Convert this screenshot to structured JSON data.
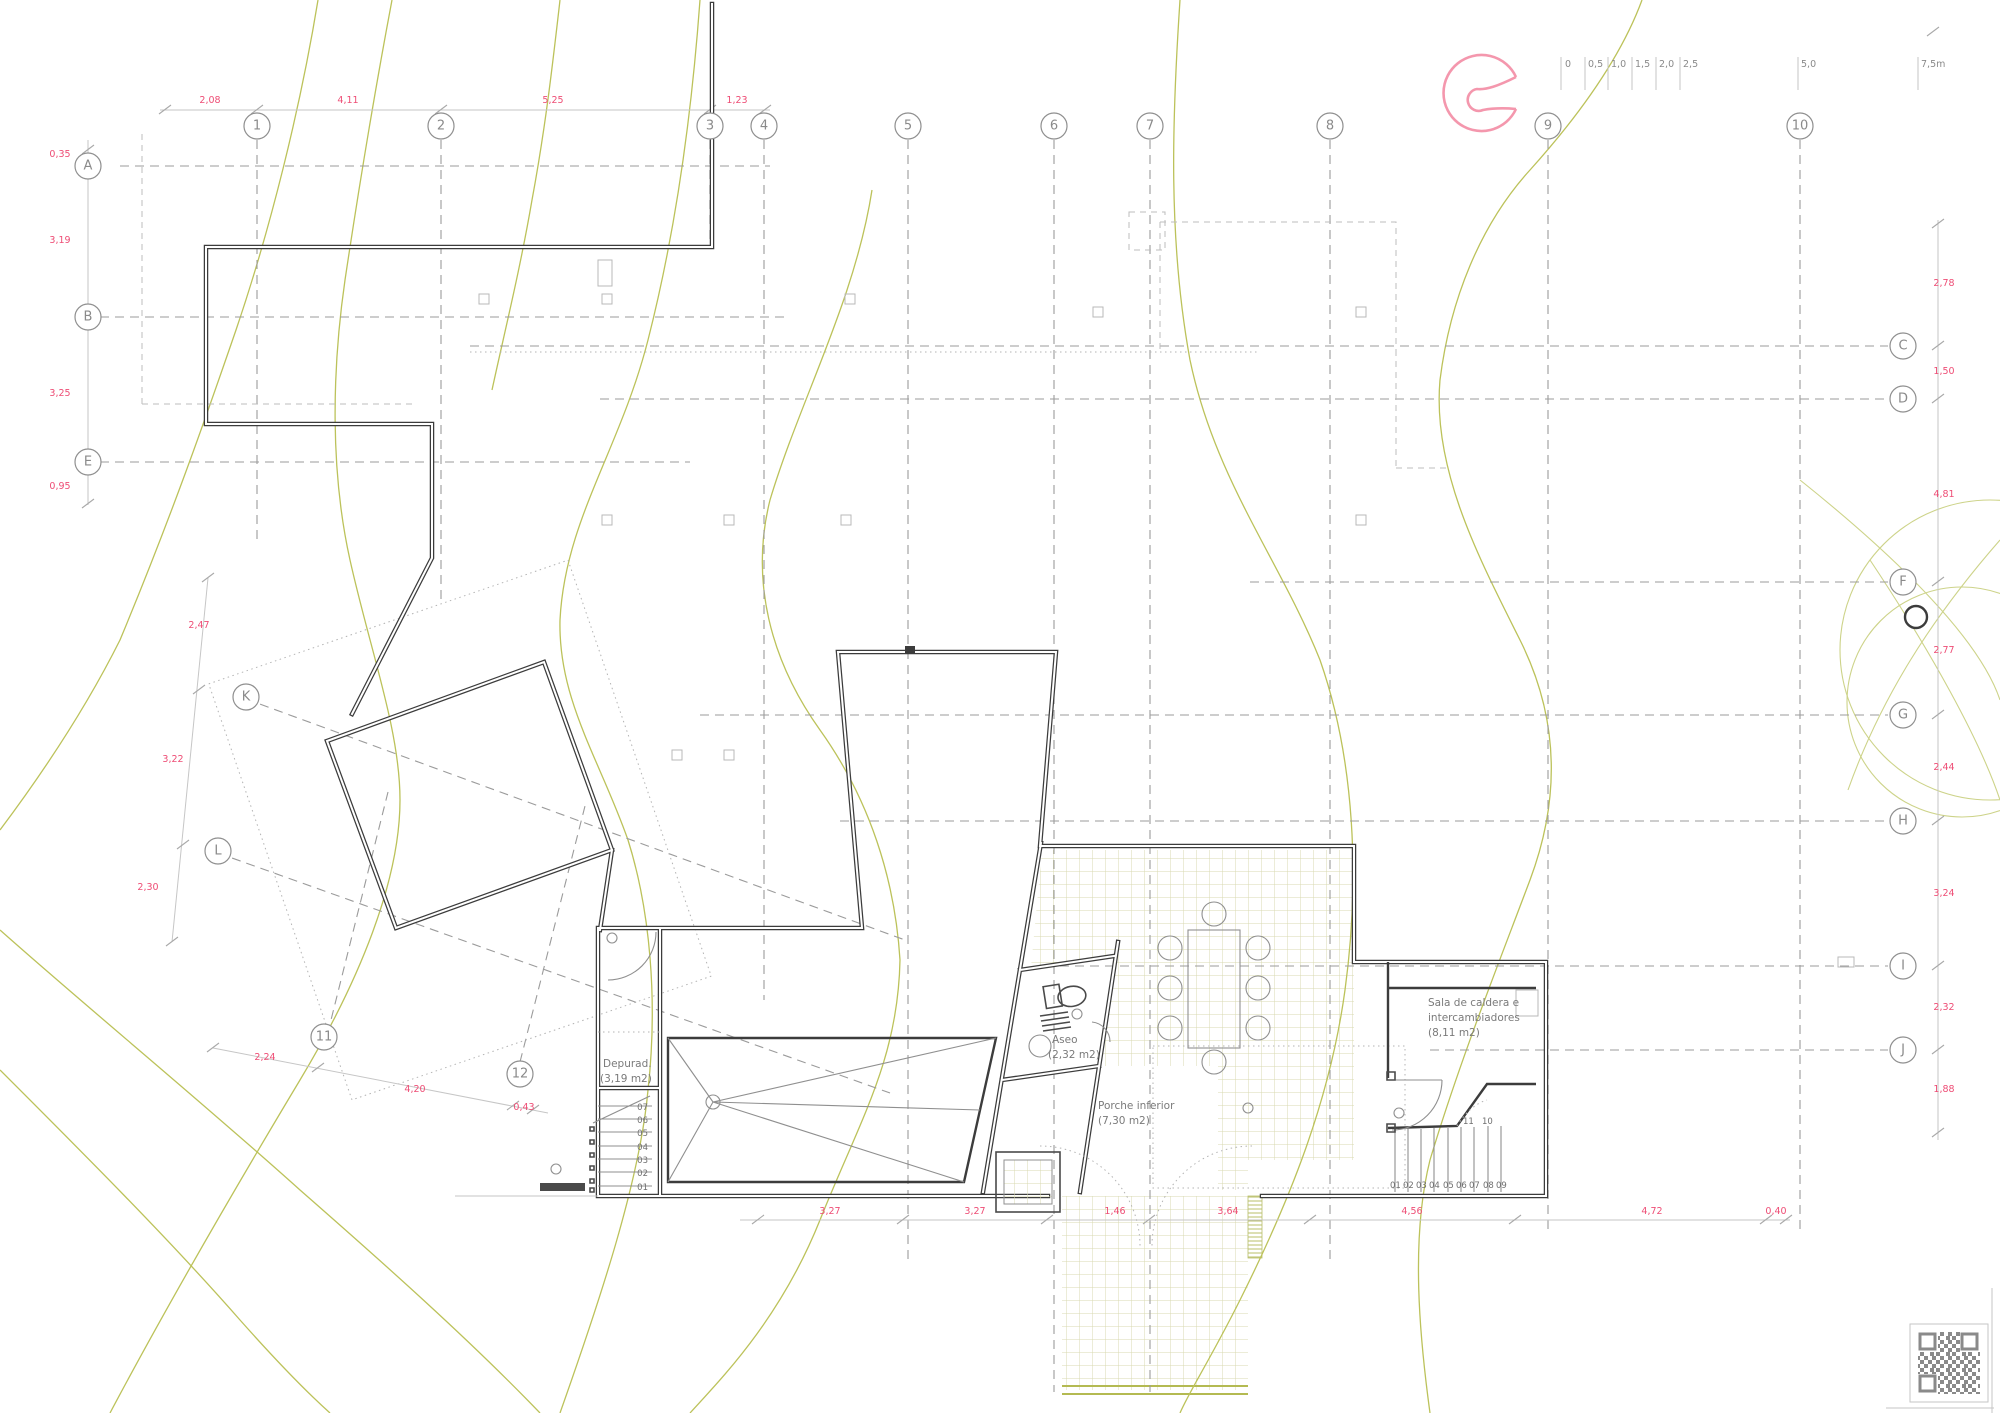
{
  "grid": {
    "cols": [
      "1",
      "2",
      "3",
      "4",
      "5",
      "6",
      "7",
      "8",
      "9",
      "10"
    ],
    "rows_left": [
      "A",
      "B",
      "E"
    ],
    "rows_right": [
      "C",
      "D",
      "F",
      "G",
      "H",
      "I",
      "J"
    ],
    "rows_diag": [
      "K",
      "L"
    ],
    "cols_diag": [
      "11",
      "12"
    ]
  },
  "dims": {
    "top": [
      "2,08",
      "4,11",
      "5,25",
      "1,23"
    ],
    "left": [
      "0,35",
      "3,19",
      "3,25",
      "0,95"
    ],
    "right": [
      "2,78",
      "1,50",
      "4,81",
      "2,77",
      "2,44",
      "3,24",
      "2,32",
      "1,88"
    ],
    "left_lower": [
      "2,47",
      "3,22",
      "2,30"
    ],
    "bottom_left": [
      "2,24",
      "4,20",
      "0,43"
    ],
    "bottom": [
      "3,27",
      "3,27",
      "1,46",
      "3,64",
      "4,56",
      "4,72",
      "0,40"
    ]
  },
  "scalebar": {
    "labels": [
      "0",
      "0,5",
      "1,0",
      "1,5",
      "2,0",
      "2,5",
      "5,0",
      "7,5m"
    ]
  },
  "rooms": {
    "depurad": {
      "name": "Depurad.",
      "area": "(3,19 m2)"
    },
    "aseo": {
      "name": "Aseo",
      "area": "(2,32 m2)"
    },
    "porche": {
      "name": "Porche inferior",
      "area": "(7,30 m2)"
    },
    "sala": {
      "line1": "Sala de caldera e",
      "line2": "intercambiadores",
      "area": "(8,11 m2)"
    }
  },
  "stairs": {
    "left": [
      "07",
      "06",
      "05",
      "04",
      "03",
      "02",
      "01"
    ],
    "sala": [
      "01",
      "02",
      "03",
      "04",
      "05",
      "06",
      "07",
      "08",
      "09"
    ],
    "sala_upper": [
      "11",
      "10"
    ]
  },
  "colors": {
    "dimension_pink": "#ee4d75",
    "logo_pink": "#f497ad",
    "contour_olive": "#bcc25a",
    "wall_dark": "#3c3c3c",
    "grid_gray": "#9b9b9b"
  }
}
